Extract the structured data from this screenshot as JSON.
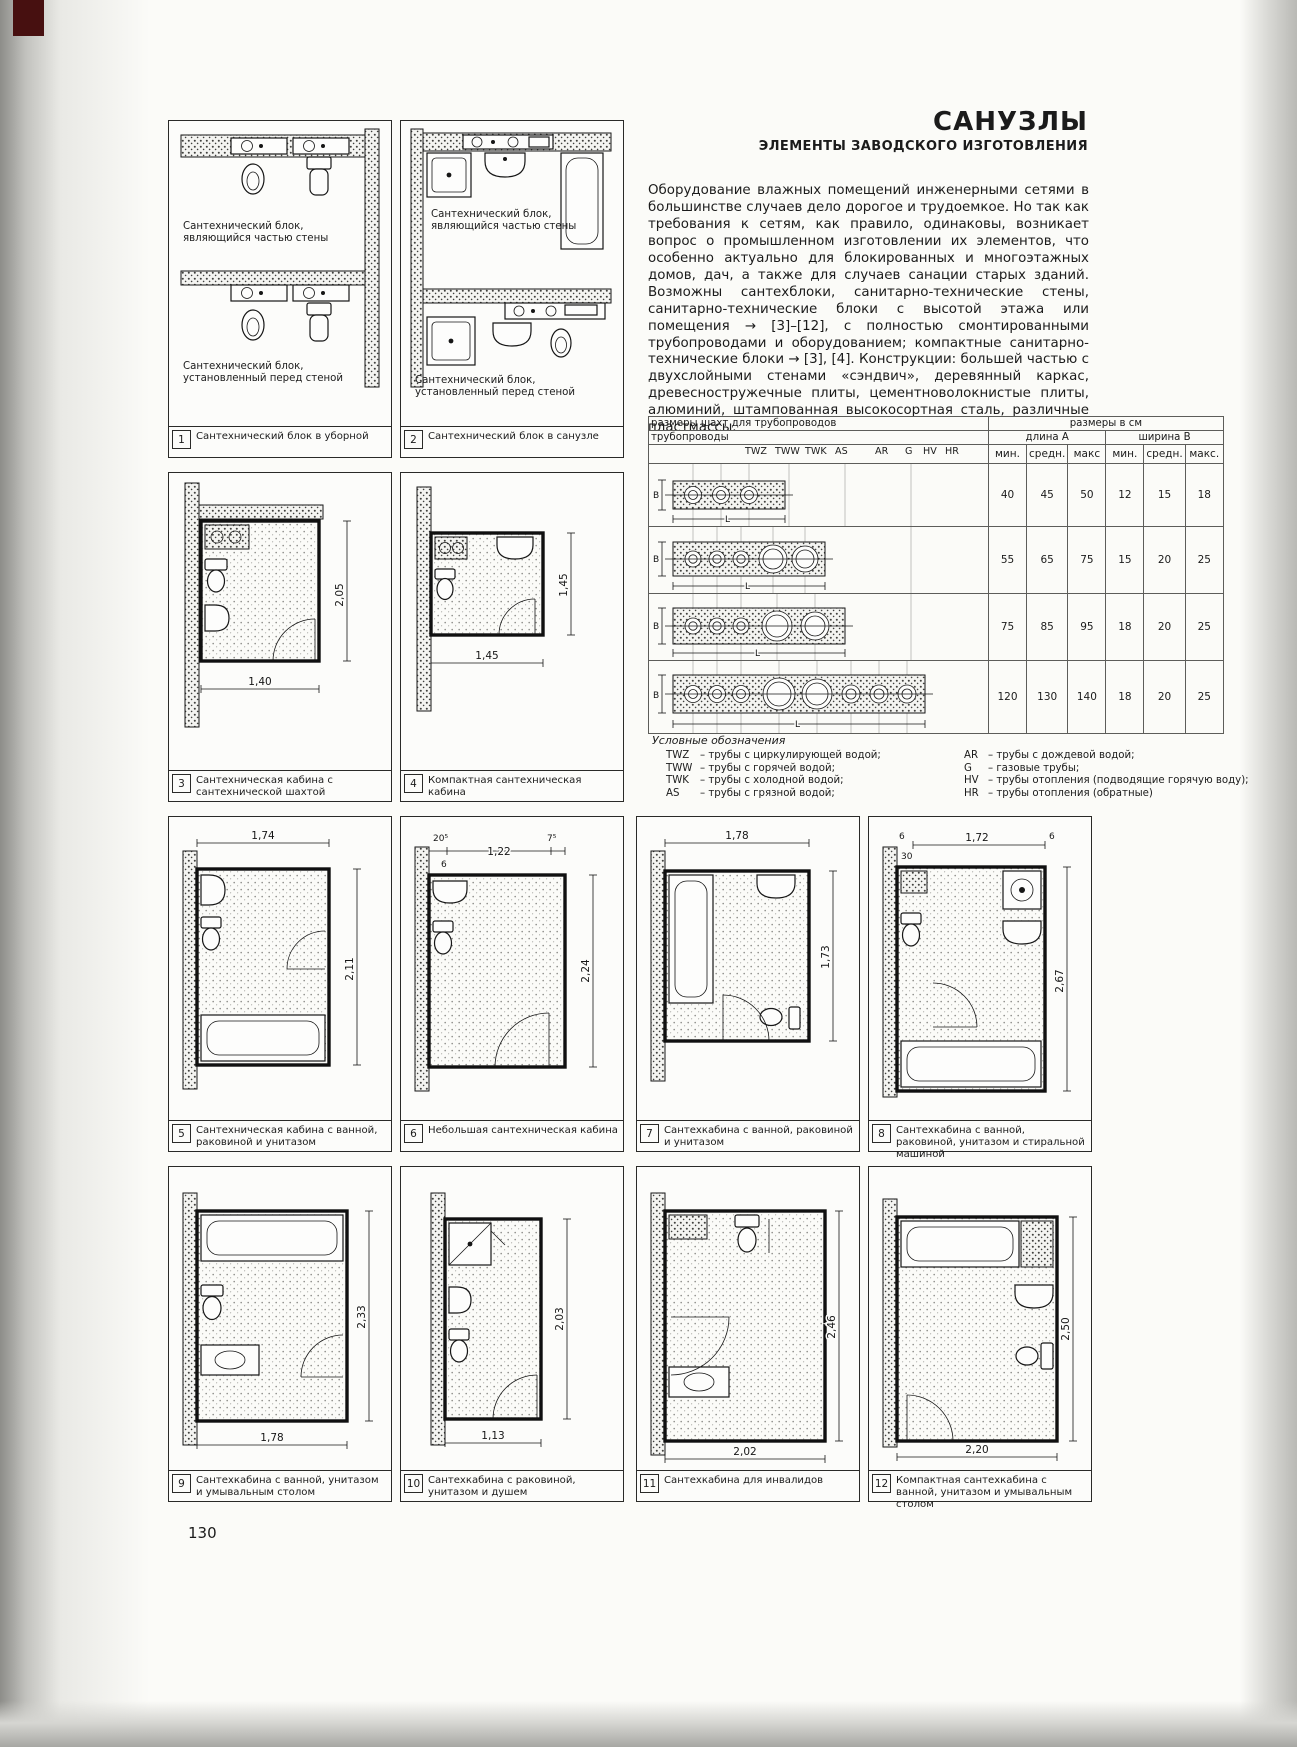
{
  "page_number": "130",
  "header": {
    "title": "САНУЗЛЫ",
    "subtitle": "ЭЛЕМЕНТЫ ЗАВОДСКОГО ИЗГОТОВЛЕНИЯ"
  },
  "intro": "Оборудование влажных помещений инженерными сетями в большинстве случаев дело дорогое и трудоемкое. Но так как требования к сетям, как правило, одинаковы, возникает вопрос о промышленном изготовлении их элементов, что особенно актуально для блокированных и многоэтажных домов, дач, а также для случаев санации старых зданий. Возможны сантехблоки, санитарно-технические стены, санитарно-технические блоки с высотой этажа или помещения → [3]–[12], с полностью смонтированными трубопроводами и оборудованием; компактные санитарно-технические блоки → [3], [4]. Конструкции: большей частью с двухслойными стенами «сэндвич», деревянный каркас, древесностружечные плиты, цементноволокнистые плиты, алюминий, штампованная высокосортная сталь, различные пластмассы.",
  "shaft_table": {
    "title_left": "размеры шахт для трубопроводов",
    "title_right": "размеры в см",
    "pipes_header": "трубопроводы",
    "length_header": "длина A",
    "width_header": "ширина B",
    "pipe_cols": [
      "TWZ",
      "TWW",
      "TWK",
      "AS",
      "AR",
      "G",
      "HV",
      "HR"
    ],
    "stat_cols": [
      "мин.",
      "средн.",
      "макс",
      "мин.",
      "средн.",
      "макс."
    ],
    "axis_b": "B",
    "axis_l": "L",
    "rows": [
      {
        "length": [
          "40",
          "45",
          "50"
        ],
        "width": [
          "12",
          "15",
          "18"
        ]
      },
      {
        "length": [
          "55",
          "65",
          "75"
        ],
        "width": [
          "15",
          "20",
          "25"
        ]
      },
      {
        "length": [
          "75",
          "85",
          "95"
        ],
        "width": [
          "18",
          "20",
          "25"
        ]
      },
      {
        "length": [
          "120",
          "130",
          "140"
        ],
        "width": [
          "18",
          "20",
          "25"
        ]
      }
    ]
  },
  "legend": {
    "title": "Условные обозначения",
    "items_left": [
      {
        "key": "TWZ",
        "desc": "–  трубы с циркулирующей водой;"
      },
      {
        "key": "TWW",
        "desc": "–  трубы с горячей водой;"
      },
      {
        "key": "TWK",
        "desc": "–  трубы с холодной водой;"
      },
      {
        "key": "AS",
        "desc": "–  трубы с грязной водой;"
      }
    ],
    "items_right": [
      {
        "key": "AR",
        "desc": "–  трубы с дождевой водой;"
      },
      {
        "key": "G",
        "desc": "–  газовые трубы;"
      },
      {
        "key": "HV",
        "desc": "–  трубы отопления (подводящие горячую воду);"
      },
      {
        "key": "HR",
        "desc": "–  трубы отопления (обратные)"
      }
    ]
  },
  "figures": [
    {
      "num": "1",
      "caption": "Сантехнический блок в уборной",
      "label_top": "Сантехнический блок, являющийся частью стены",
      "label_bottom": "Сантехнический блок, установленный перед стеной"
    },
    {
      "num": "2",
      "caption": "Сантехнический блок в санузле",
      "label_top": "Сантехнический блок, являющийся частью стены",
      "label_bottom": "Сантехнический блок, установленный перед стеной"
    },
    {
      "num": "3",
      "caption": "Сантехническая кабина с сантехнической шахтой",
      "dim_h": "2,05",
      "dim_w": "1,40"
    },
    {
      "num": "4",
      "caption": "Компактная сантехническая кабина",
      "dim_h": "1,45",
      "dim_w": "1,45"
    },
    {
      "num": "5",
      "caption": "Сантехническая кабина с ванной, раковиной и унитазом",
      "dim_w": "1,74",
      "dim_h": "2,11"
    },
    {
      "num": "6",
      "caption": "Небольшая сантехническая кабина",
      "dim_a": "20⁵",
      "dim_w": "1,22",
      "dim_b": "7⁵",
      "dim_c": "6",
      "dim_h": "2,24"
    },
    {
      "num": "7",
      "caption": "Сантехкабина с ванной, раковиной и унитазом",
      "dim_w": "1,78",
      "dim_h": "1,73"
    },
    {
      "num": "8",
      "caption": "Сантехкабина с ванной, раковиной, унитазом и стиральной машиной",
      "dim_a": "6",
      "dim_b": "30",
      "dim_w": "1,72",
      "dim_c": "6",
      "dim_h": "2,67"
    },
    {
      "num": "9",
      "caption": "Сантехкабина с ванной, унитазом и умывальным столом",
      "dim_h": "2,33",
      "dim_w": "1,78"
    },
    {
      "num": "10",
      "caption": "Сантехкабина с раковиной, унитазом и душем",
      "dim_h": "2,03",
      "dim_w": "1,13"
    },
    {
      "num": "11",
      "caption": "Сантехкабина для инвалидов",
      "dim_h": "2,46",
      "dim_w": "2,02"
    },
    {
      "num": "12",
      "caption": "Компактная сантехкабина с ванной, унитазом и умывальным столом",
      "dim_h": "2,50",
      "dim_w": "2,20"
    }
  ]
}
